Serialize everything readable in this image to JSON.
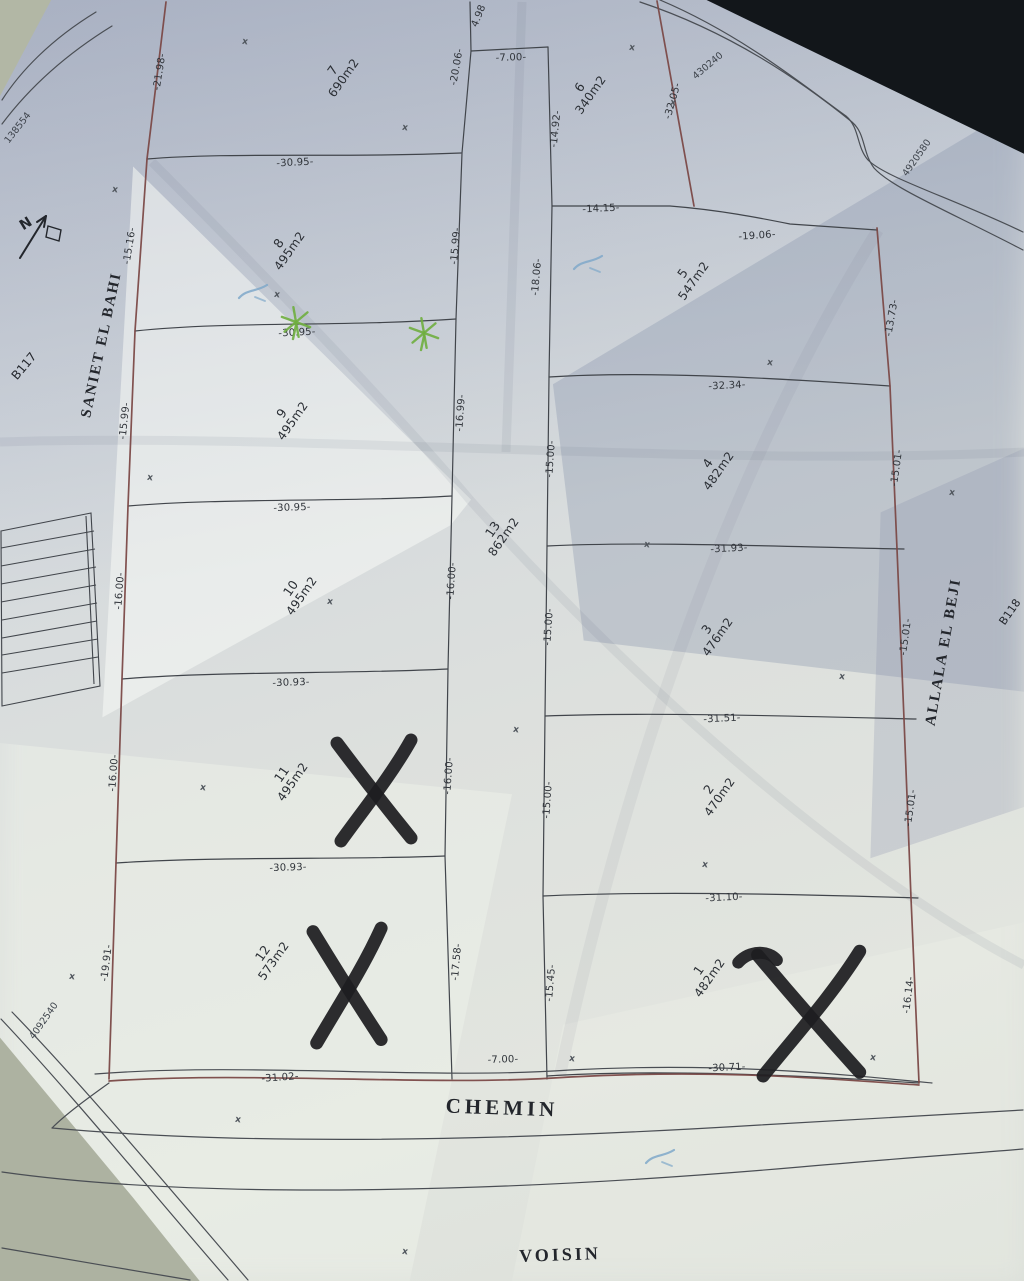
{
  "streets": {
    "left": {
      "text": "SANIET EL BAHI"
    },
    "left_far": {
      "text": "B117"
    },
    "right": {
      "text": "ALLALA EL BEJI"
    },
    "right_far": {
      "text": "B118"
    },
    "bottom_road": {
      "text": "CHEMIN"
    },
    "bottom_neighbor": {
      "text": "VOISIN"
    }
  },
  "compass": {
    "letter": "N"
  },
  "parcels": [
    {
      "num": "7",
      "area": "690m2",
      "x": 338,
      "y": 74,
      "rot": -55
    },
    {
      "num": "6",
      "area": "340m2",
      "x": 585,
      "y": 91,
      "rot": -55
    },
    {
      "num": "8",
      "area": "495m2",
      "x": 284,
      "y": 247,
      "rot": -55
    },
    {
      "num": "5",
      "area": "547m2",
      "x": 688,
      "y": 277,
      "rot": -55
    },
    {
      "num": "9",
      "area": "495m2",
      "x": 287,
      "y": 417,
      "rot": -55
    },
    {
      "num": "4",
      "area": "482m2",
      "x": 713,
      "y": 467,
      "rot": -55
    },
    {
      "num": "13",
      "area": "862m2",
      "x": 498,
      "y": 533,
      "rot": -55
    },
    {
      "num": "10",
      "area": "495m2",
      "x": 296,
      "y": 592,
      "rot": -55
    },
    {
      "num": "3",
      "area": "476m2",
      "x": 712,
      "y": 633,
      "rot": -55
    },
    {
      "num": "11",
      "area": "495m2",
      "x": 287,
      "y": 778,
      "rot": -55
    },
    {
      "num": "2",
      "area": "470m2",
      "x": 714,
      "y": 793,
      "rot": -55
    },
    {
      "num": "12",
      "area": "573m2",
      "x": 268,
      "y": 957,
      "rot": -55
    },
    {
      "num": "1",
      "area": "482m2",
      "x": 704,
      "y": 974,
      "rot": -55
    }
  ],
  "dimensions": [
    {
      "text": "-30.95-",
      "x": 295,
      "y": 163,
      "rot": -3
    },
    {
      "text": "-30.95-",
      "x": 297,
      "y": 333,
      "rot": -3
    },
    {
      "text": "-30.95-",
      "x": 292,
      "y": 508,
      "rot": -2
    },
    {
      "text": "-30.93-",
      "x": 291,
      "y": 683,
      "rot": -2
    },
    {
      "text": "-30.93-",
      "x": 288,
      "y": 868,
      "rot": -2
    },
    {
      "text": "-31.02-",
      "x": 280,
      "y": 1078,
      "rot": -4
    },
    {
      "text": "-21.98-",
      "x": 160,
      "y": 72,
      "rot": -81
    },
    {
      "text": "-15.16-",
      "x": 130,
      "y": 246,
      "rot": -81
    },
    {
      "text": "-15.99-",
      "x": 125,
      "y": 421,
      "rot": -84
    },
    {
      "text": "-16.00-",
      "x": 120,
      "y": 591,
      "rot": -86
    },
    {
      "text": "-16.00-",
      "x": 114,
      "y": 773,
      "rot": -86
    },
    {
      "text": "-19.91-",
      "x": 107,
      "y": 963,
      "rot": -83
    },
    {
      "text": "-20.06-",
      "x": 457,
      "y": 67,
      "rot": -80
    },
    {
      "text": "-15.99-",
      "x": 456,
      "y": 246,
      "rot": -85
    },
    {
      "text": "-16.99-",
      "x": 461,
      "y": 413,
      "rot": -86
    },
    {
      "text": "-16.00-",
      "x": 452,
      "y": 581,
      "rot": -86
    },
    {
      "text": "-16.00-",
      "x": 449,
      "y": 776,
      "rot": -86
    },
    {
      "text": "-17.58-",
      "x": 457,
      "y": 962,
      "rot": -85
    },
    {
      "text": "-7.00-",
      "x": 511,
      "y": 58,
      "rot": -2
    },
    {
      "text": "4.98",
      "x": 479,
      "y": 16,
      "rot": -68
    },
    {
      "text": "-14.92-",
      "x": 556,
      "y": 129,
      "rot": -84
    },
    {
      "text": "-32.05-",
      "x": 673,
      "y": 101,
      "rot": -74
    },
    {
      "text": "-14.15-",
      "x": 601,
      "y": 209,
      "rot": -3
    },
    {
      "text": "-19.06-",
      "x": 757,
      "y": 236,
      "rot": -4
    },
    {
      "text": "-18.06-",
      "x": 537,
      "y": 277,
      "rot": -85
    },
    {
      "text": "-13.73-",
      "x": 892,
      "y": 318,
      "rot": -80
    },
    {
      "text": "-32.34-",
      "x": 727,
      "y": 386,
      "rot": -3
    },
    {
      "text": "-15.00-",
      "x": 551,
      "y": 459,
      "rot": -86
    },
    {
      "text": "-15.01-",
      "x": 897,
      "y": 468,
      "rot": -82
    },
    {
      "text": "-31.93-",
      "x": 729,
      "y": 549,
      "rot": -3
    },
    {
      "text": "-15.00-",
      "x": 549,
      "y": 627,
      "rot": -86
    },
    {
      "text": "-15.01-",
      "x": 906,
      "y": 637,
      "rot": -82
    },
    {
      "text": "-31.51-",
      "x": 722,
      "y": 719,
      "rot": -3
    },
    {
      "text": "-15.00-",
      "x": 548,
      "y": 800,
      "rot": -86
    },
    {
      "text": "-15.01-",
      "x": 911,
      "y": 808,
      "rot": -82
    },
    {
      "text": "-31.10-",
      "x": 724,
      "y": 898,
      "rot": -3
    },
    {
      "text": "-15.45-",
      "x": 551,
      "y": 983,
      "rot": -85
    },
    {
      "text": "-16.14-",
      "x": 909,
      "y": 995,
      "rot": -83
    },
    {
      "text": "-30.71-",
      "x": 727,
      "y": 1068,
      "rot": -3
    },
    {
      "text": "-7.00-",
      "x": 503,
      "y": 1060,
      "rot": -2
    }
  ],
  "coordinate_refs": [
    {
      "text": "138554",
      "x": 18,
      "y": 128,
      "rot": -52
    },
    {
      "text": "430240",
      "x": 708,
      "y": 66,
      "rot": -40
    },
    {
      "text": "4920580",
      "x": 917,
      "y": 158,
      "rot": -55
    },
    {
      "text": "4092540",
      "x": 44,
      "y": 1021,
      "rot": -55
    }
  ],
  "annotations": {
    "marker_x_color": "#1d1d20",
    "x_marks": [
      {
        "cx": 375,
        "cy": 790,
        "sx": 1.0,
        "sy": 1.02,
        "hook": false
      },
      {
        "cx": 348,
        "cy": 985,
        "sx": 0.92,
        "sy": 1.16,
        "hook": false
      },
      {
        "cx": 810,
        "cy": 1013,
        "sx": 1.38,
        "sy": 1.26,
        "hook": true
      }
    ],
    "plant_color": "#6fae3f",
    "plant_marks": [
      {
        "x": 296,
        "y": 322
      },
      {
        "x": 424,
        "y": 333
      }
    ],
    "pen_color": "#7fa8c9",
    "pen_marks": [
      {
        "x": 253,
        "y": 291
      },
      {
        "x": 588,
        "y": 262
      },
      {
        "x": 660,
        "y": 1156
      }
    ],
    "survey_cross_glyph": "x",
    "survey_crosses": [
      {
        "x": 245,
        "y": 42
      },
      {
        "x": 405,
        "y": 128
      },
      {
        "x": 115,
        "y": 190
      },
      {
        "x": 632,
        "y": 48
      },
      {
        "x": 673,
        "y": 103
      },
      {
        "x": 277,
        "y": 295
      },
      {
        "x": 150,
        "y": 478
      },
      {
        "x": 330,
        "y": 602
      },
      {
        "x": 203,
        "y": 788
      },
      {
        "x": 516,
        "y": 730
      },
      {
        "x": 647,
        "y": 545
      },
      {
        "x": 770,
        "y": 363
      },
      {
        "x": 952,
        "y": 493
      },
      {
        "x": 842,
        "y": 677
      },
      {
        "x": 705,
        "y": 865
      },
      {
        "x": 572,
        "y": 1059
      },
      {
        "x": 873,
        "y": 1058
      },
      {
        "x": 238,
        "y": 1120
      },
      {
        "x": 405,
        "y": 1252
      },
      {
        "x": 72,
        "y": 977
      }
    ]
  },
  "colors": {
    "boundary_red": "#7b4947",
    "line": "#41454b",
    "paper": "#d9dde0",
    "table": "#adb2a1",
    "shadow": "#12161a"
  }
}
